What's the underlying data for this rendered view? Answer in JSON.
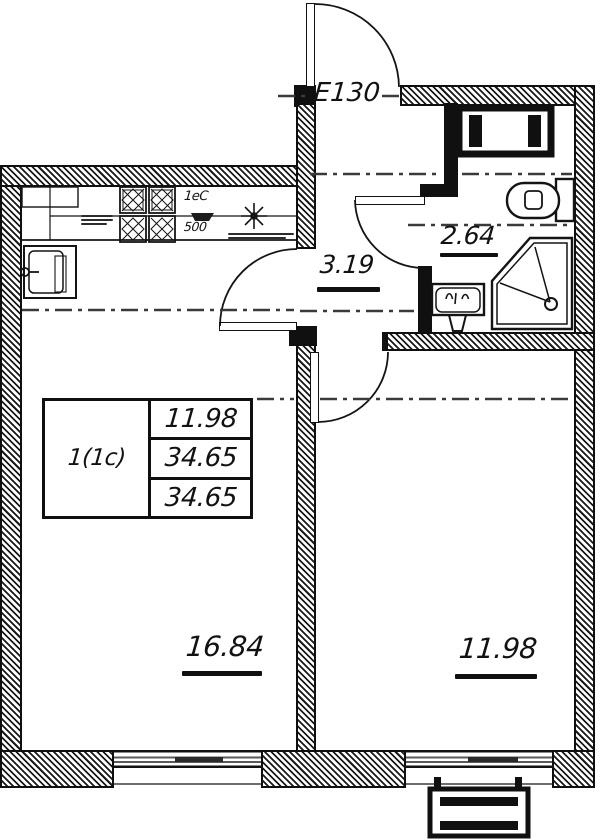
{
  "labels": {
    "unit": "Е130",
    "hall_area": "3.19",
    "bathroom_area": "2.64",
    "living_room_area": "16.84",
    "bedroom_area": "11.98"
  },
  "summary_table": {
    "flat_type": "1(1с)",
    "rows": [
      "11.98",
      "34.65",
      "34.65"
    ]
  },
  "kitchen": {
    "unit_label": "1еС",
    "depth_label": "500"
  },
  "colors": {
    "ink": "#101010",
    "paper": "#ffffff"
  }
}
